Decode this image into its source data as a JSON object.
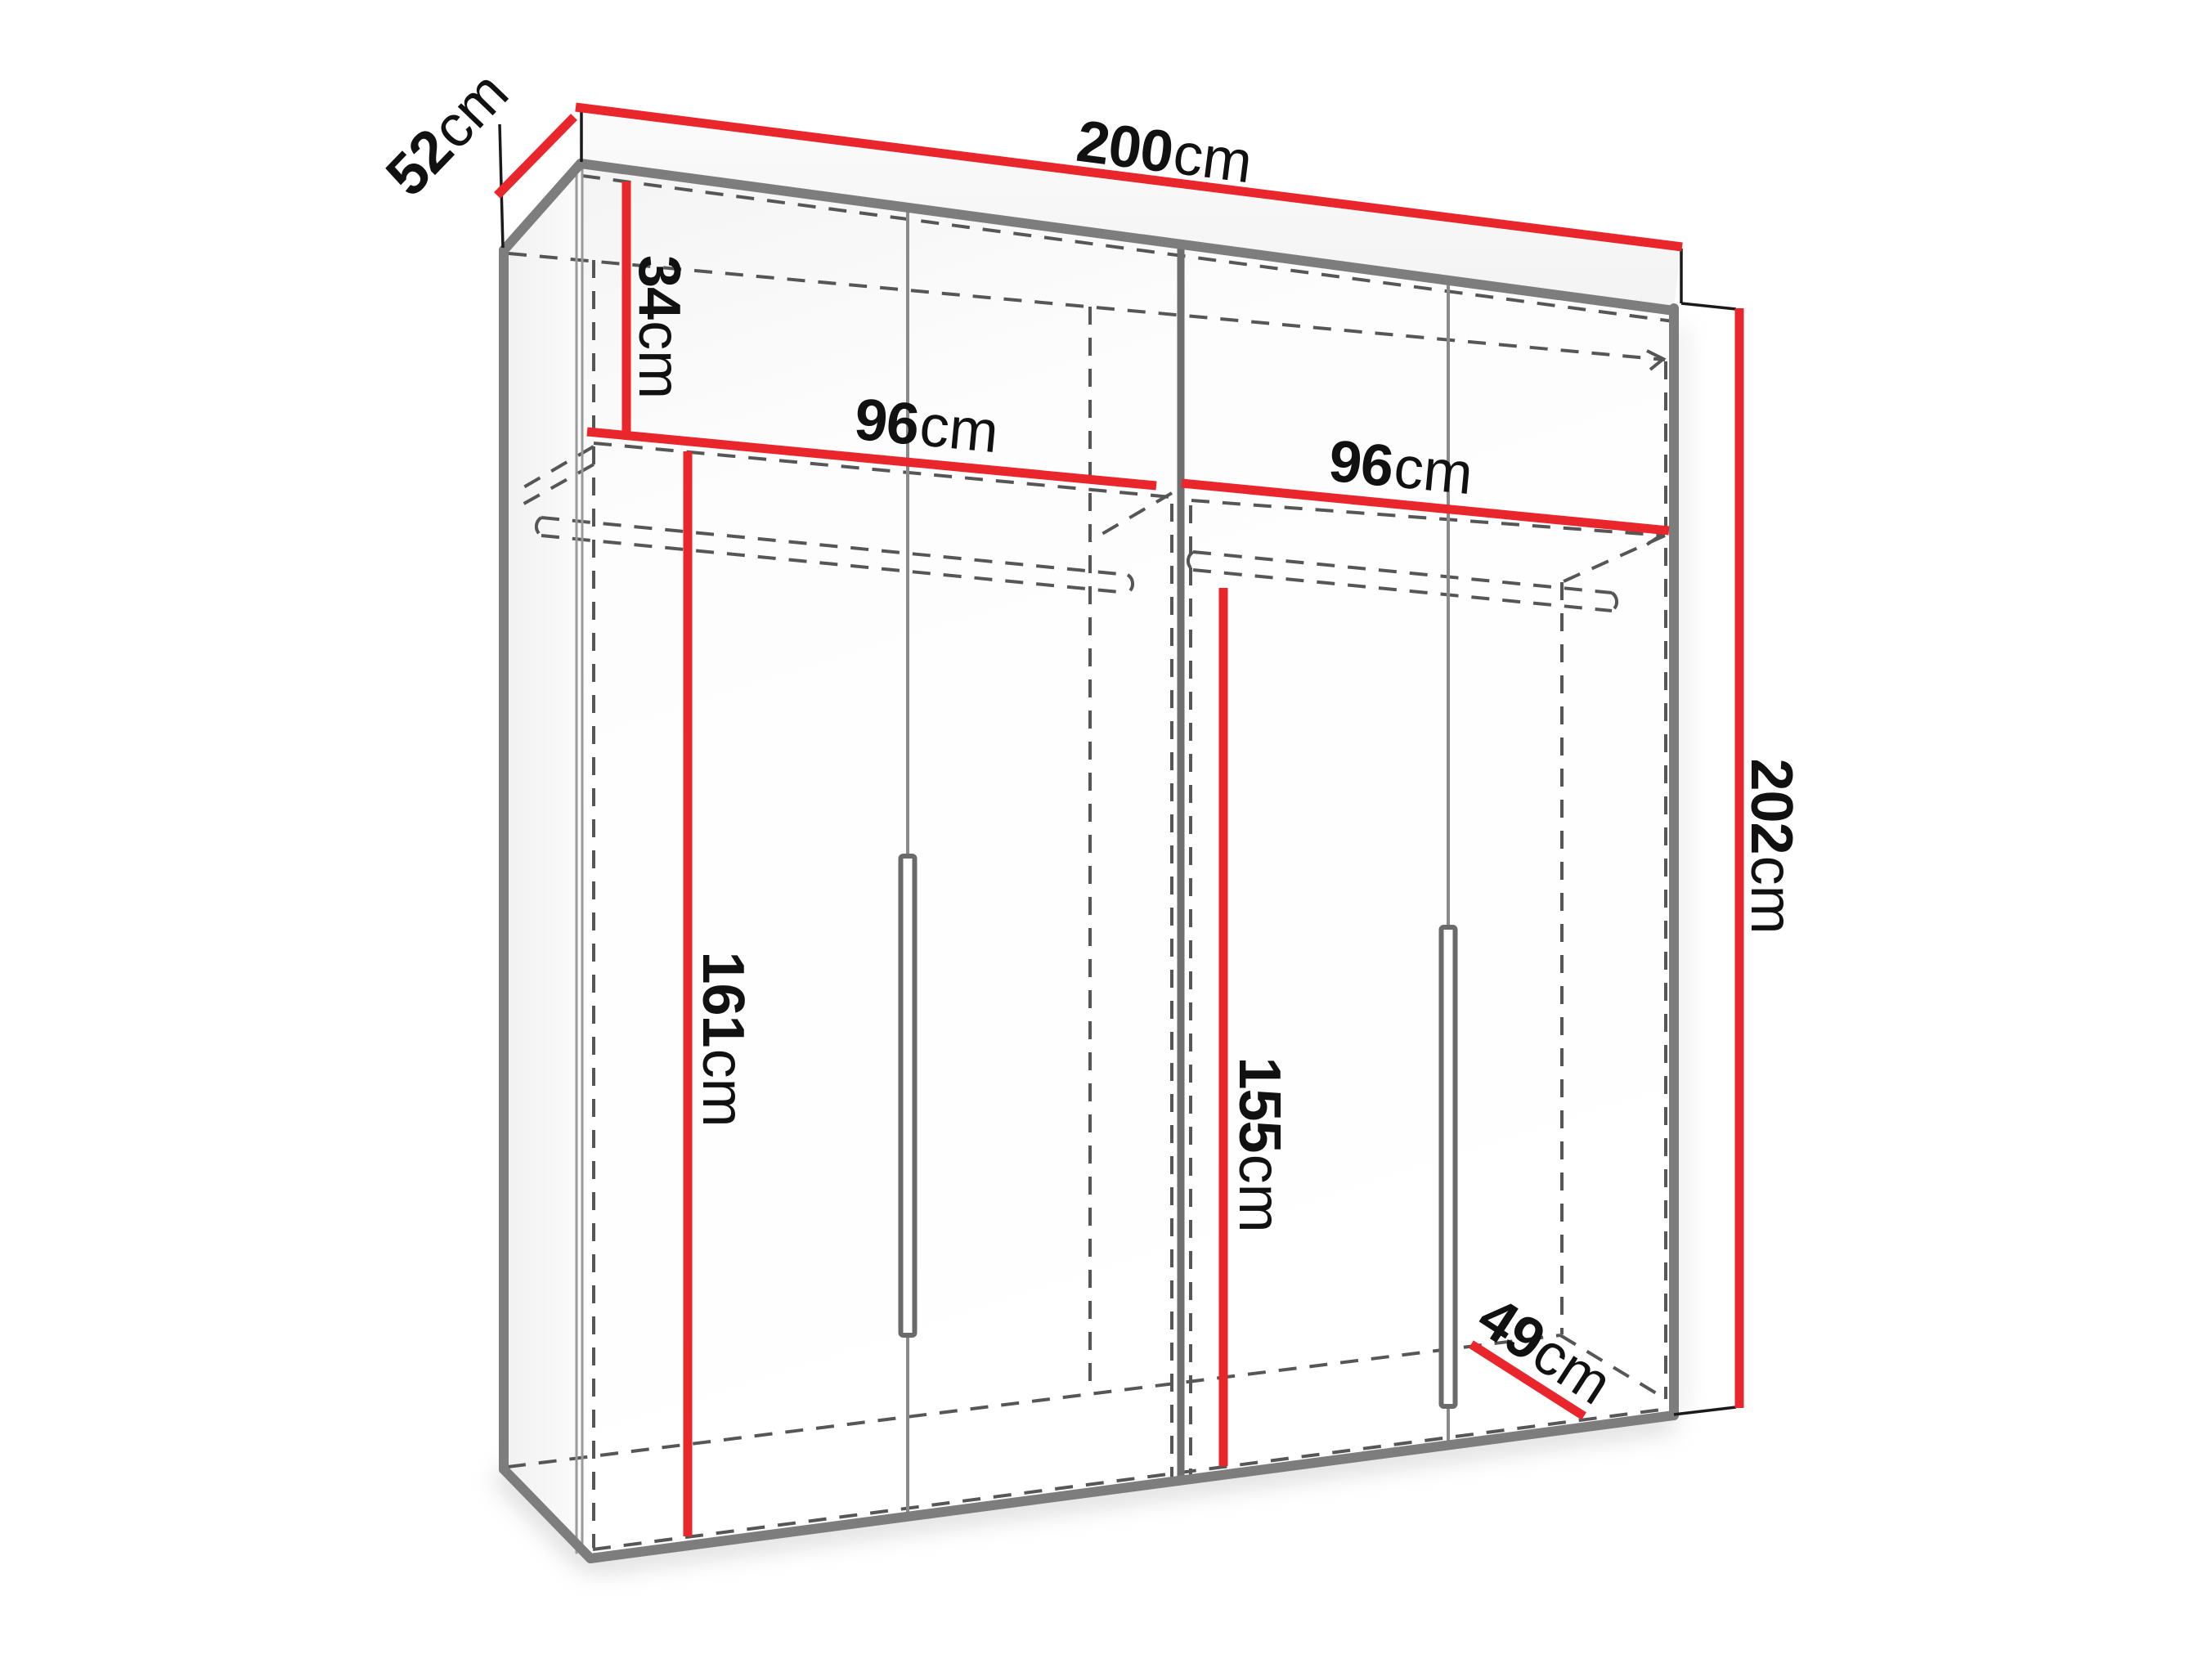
{
  "diagram": {
    "title": "wardrobe-dimension-diagram",
    "unit": "cm",
    "dims": {
      "width": {
        "value": "200",
        "unit": "cm"
      },
      "depth": {
        "value": "52",
        "unit": "cm"
      },
      "height": {
        "value": "202",
        "unit": "cm"
      },
      "top_shelf_height": {
        "value": "34",
        "unit": "cm"
      },
      "left_section_width": {
        "value": "96",
        "unit": "cm"
      },
      "right_section_width": {
        "value": "96",
        "unit": "cm"
      },
      "left_hanging_height": {
        "value": "161",
        "unit": "cm"
      },
      "right_hanging_height": {
        "value": "155",
        "unit": "cm"
      },
      "usable_depth": {
        "value": "49",
        "unit": "cm"
      }
    },
    "colors": {
      "dimension_red": "#e8262b",
      "frame_gray": "#7d7d7d",
      "divider_gray": "#6f6f6f",
      "hidden_line_gray": "#565656",
      "label_black": "#111111",
      "background": "#ffffff"
    }
  }
}
